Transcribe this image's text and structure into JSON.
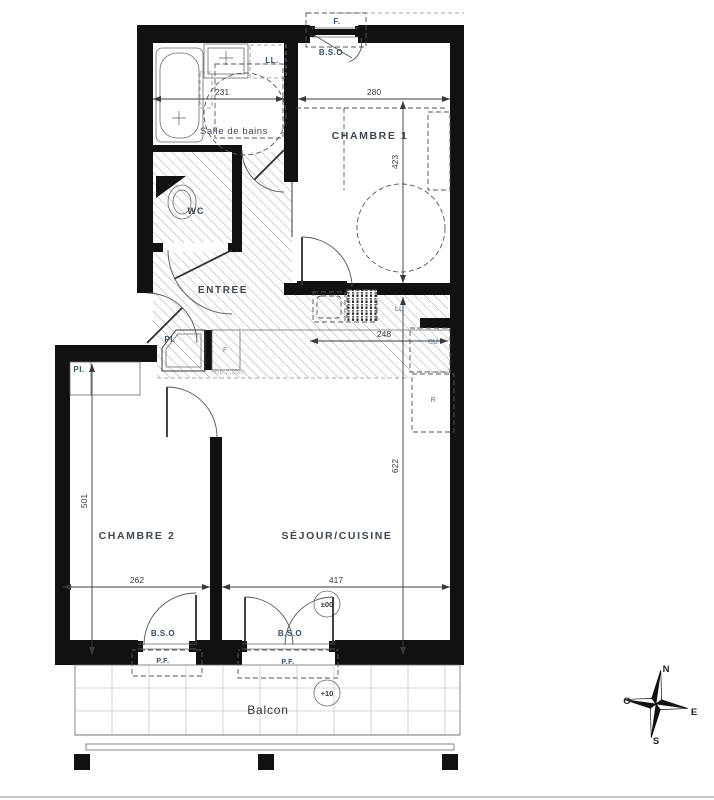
{
  "plan": {
    "rooms": {
      "salle_de_bains": "Salle de bains",
      "wc": "WC",
      "entree": "ENTREE",
      "chambre1": "CHAMBRE 1",
      "chambre2": "CHAMBRE 2",
      "sejour_cuisine": "SÉJOUR/CUISINE",
      "balcon": "Balcon"
    },
    "dimensions_cm": {
      "salle_de_bains_width": "231",
      "chambre1_width": "280",
      "chambre1_depth": "423",
      "cuisine_width": "248",
      "chambre2_depth": "501",
      "chambre2_width": "262",
      "sejour_width": "417",
      "sejour_depth": "622"
    },
    "annotations": {
      "window_top": "F.",
      "bso_top": "B.S.O",
      "lave_linge_bain": "LL.",
      "placard_entree": "Pl.",
      "placard_chambre2": "Pl.",
      "four": "F",
      "lave_linge_cuisine": "LL",
      "cuisson": "CU",
      "refrigerateur": "R",
      "hauteur_sous_plafond": "Hsp 2,25m",
      "bso_chambre2": "B.S.O",
      "pf_chambre2": "P.F.",
      "bso_sejour": "B.S.O",
      "pf_sejour": "P.F.",
      "niveau_interieur": "±00",
      "niveau_balcon": "+10"
    },
    "compass": {
      "north": "N",
      "west": "O",
      "east": "E",
      "south": "S"
    },
    "colors": {
      "wall": "#111111",
      "annotation": "#35506e",
      "annotation_light": "#8aa0b8",
      "dimension": "#3a3a3a",
      "room_label": "#3f4652",
      "hatch": "#9a9a9a"
    }
  }
}
